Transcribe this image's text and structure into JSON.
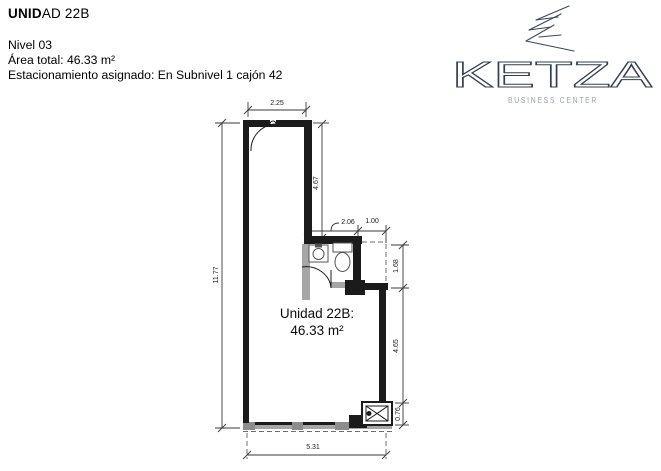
{
  "header": {
    "title_bold": "UNID",
    "title_rest": "AD 22B",
    "line1": "Nivel 03",
    "line2": "Área total: 46.33 m²",
    "line3": "Estacionamiento asignado: En Subnivel 1 cajón 42"
  },
  "brand": {
    "name": "KETZA",
    "tagline": "BUSINESS CENTER",
    "brand_color": "#333f50",
    "tagline_color": "#99a1ab"
  },
  "plan": {
    "unit_label_line1": "Unidad 22B:",
    "unit_label_line2": "46.33 m²",
    "dimensions": {
      "top_width": "2.25",
      "corridor_length": "4.67",
      "bath_width": "2.06",
      "bath_offset": "1.00",
      "right_upper": "1.68",
      "left_height": "11.77",
      "right_lower": "4.65",
      "shaft_height": "0.76",
      "bottom_width": "5.31"
    },
    "colors": {
      "wall": "#1b1b1b",
      "gray_wall": "#a6a6a6",
      "dim_line": "#3a3a3a"
    }
  }
}
